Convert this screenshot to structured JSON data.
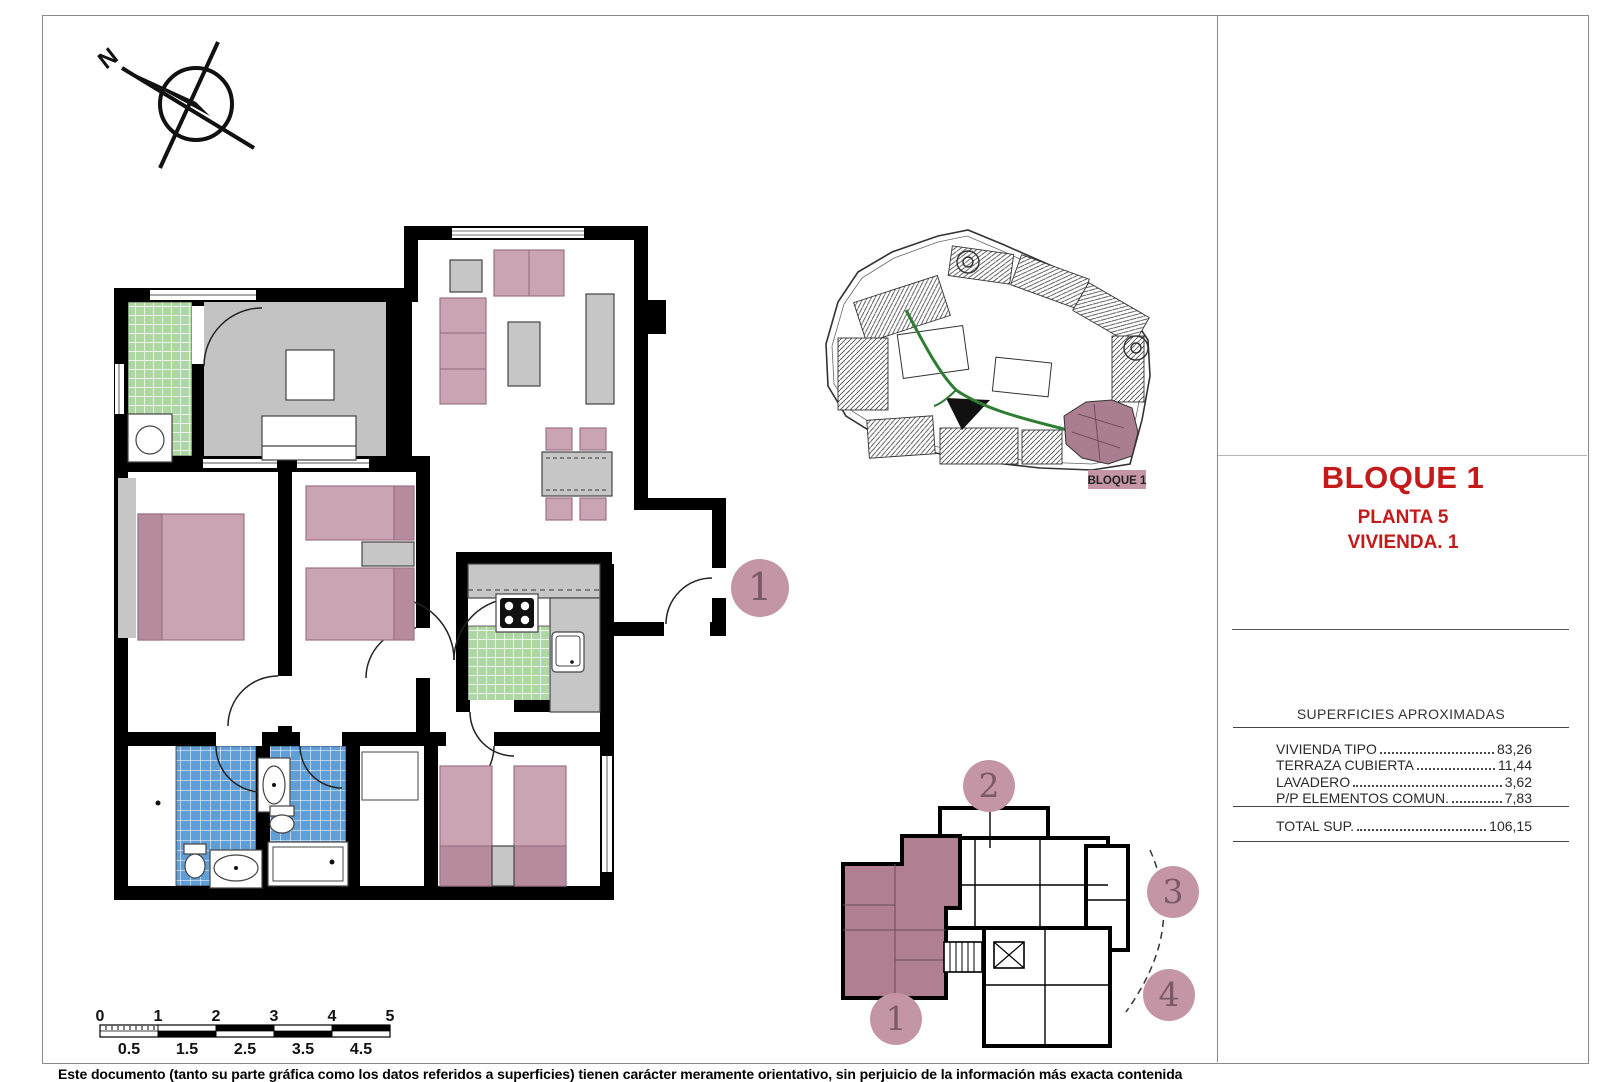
{
  "title_block": {
    "title": "BLOQUE 1",
    "subtitle_line1": "PLANTA 5",
    "subtitle_line2": "VIVIENDA. 1"
  },
  "areas_table": {
    "header": "SUPERFICIES APROXIMADAS",
    "rows": [
      {
        "label": "VIVIENDA TIPO",
        "value": "83,26"
      },
      {
        "label": "TERRAZA CUBIERTA",
        "value": "11,44"
      },
      {
        "label": "LAVADERO",
        "value": "3,62"
      },
      {
        "label": "P/P ELEMENTOS COMUN.",
        "value": "7,83"
      }
    ],
    "total": {
      "label": "TOTAL SUP.",
      "value": "106,15"
    }
  },
  "compass": {
    "north_label": "N"
  },
  "site_plan": {
    "highlight_label": "BLOQUE 1"
  },
  "main_plan": {
    "unit_circle": "1"
  },
  "key_plan": {
    "units": [
      "1",
      "2",
      "3",
      "4"
    ]
  },
  "scale_bar": {
    "major_labels": [
      "0",
      "1",
      "2",
      "3",
      "4",
      "5"
    ],
    "minor_labels": [
      "0.5",
      "1.5",
      "2.5",
      "3.5",
      "4.5"
    ]
  },
  "footer": {
    "disclaimer": "Este documento (tanto su parte gráfica como los datos referidos a superficies) tienen carácter meramente orientativo, sin perjuicio de la información más exacta contenida"
  },
  "colors": {
    "accent_red": "#C41A1A",
    "mauve": "#C495A5",
    "mauve_dark": "#B68B9E",
    "green_tile": "#AED7A3",
    "blue_tile": "#5F9ED6",
    "gray_floor": "#C3C3C3",
    "site_green": "#2E7D32"
  }
}
